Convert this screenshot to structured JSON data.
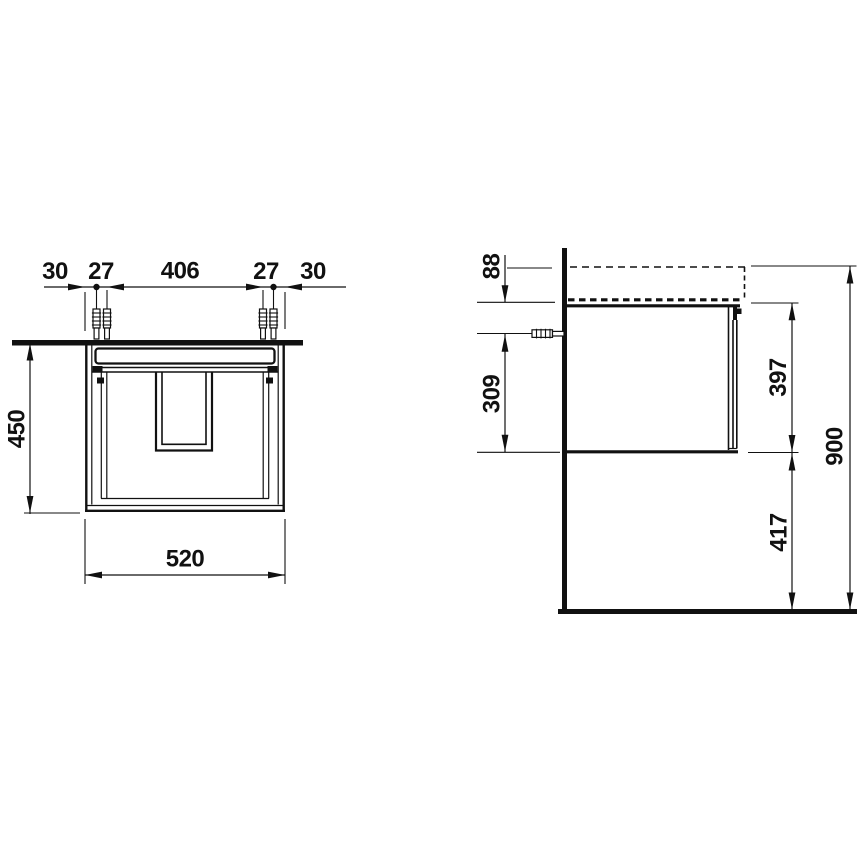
{
  "front_view": {
    "top_dimensions": [
      "30",
      "27",
      "406",
      "27",
      "30"
    ],
    "height": "450",
    "width": "520"
  },
  "side_view": {
    "top_offset": "88",
    "fixing_height": "309",
    "cabinet_height": "397",
    "bottom_clearance": "417",
    "total_height": "900"
  },
  "colors": {
    "line": "#111111",
    "background": "#ffffff"
  }
}
